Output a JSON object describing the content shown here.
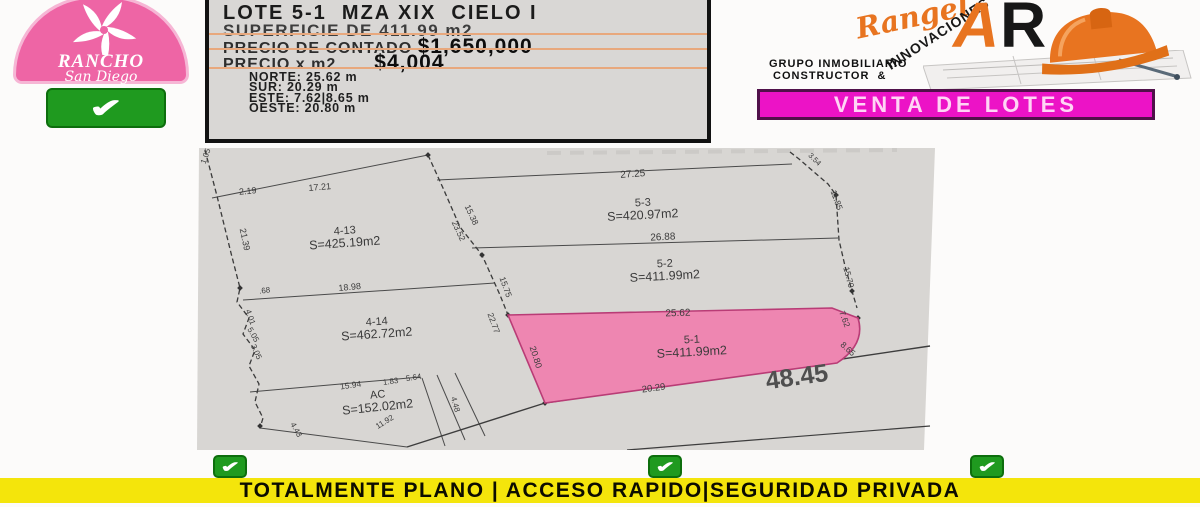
{
  "icons": {
    "check": "✔"
  },
  "colors": {
    "badge_pink": "#ee65a5",
    "check_green": "#1f9a1f",
    "magenta_banner": "#ec13c6",
    "orange_brand": "#e87420",
    "yellow_banner": "#f4e50b",
    "lot_highlight": "#ee86b1",
    "map_background": "#d8d6d3"
  },
  "header": {
    "badge": {
      "line1": "RANCHO",
      "line2": "San Diego"
    },
    "info": {
      "title": "LOTE 5-1  MZA XIX  CIELO I",
      "superficie_label": "SUPERFICIE DE ",
      "superficie_value": "411.99 m2",
      "contado_label": "PRECIO DE CONTADO ",
      "contado_value": "$1,650,000",
      "m2_label": "PRECIO x m2",
      "m2_value": "$4,004",
      "bounds": [
        {
          "label": "NORTE:",
          "value": " 25.62 m"
        },
        {
          "label": "SUR:",
          "value": " 20.29 m"
        },
        {
          "label": "ESTE:",
          "value": " 7.62|8.65 m"
        },
        {
          "label": "OESTE:",
          "value": " 20.80 m"
        }
      ]
    },
    "brand": {
      "script": "Rangel",
      "innovaciones": "INNOVACIONES",
      "monogram_a": "A",
      "monogram_r": "R",
      "tagline": "GRUPO INMOBILIARIO\n CONSTRUCTOR  &"
    },
    "venta_banner": "VENTA DE LOTES"
  },
  "map": {
    "street_label": "48.45",
    "lots": [
      {
        "id": "4-13",
        "area": "S=425.19m2",
        "x": 148,
        "y": 86,
        "r": -4
      },
      {
        "id": "5-3",
        "area": "S=420.97m2",
        "x": 446,
        "y": 58,
        "r": -3
      },
      {
        "id": "5-2",
        "area": "S=411.99m2",
        "x": 468,
        "y": 119,
        "r": -3
      },
      {
        "id": "4-14",
        "area": "S=462.72m2",
        "x": 180,
        "y": 177,
        "r": -4
      },
      {
        "id": "AC",
        "area": "S=152.02m2",
        "x": 181,
        "y": 250,
        "r": -6
      },
      {
        "id": "5-1",
        "area": "S=411.99m2",
        "x": 495,
        "y": 195,
        "r": -3,
        "highlighted": true
      }
    ],
    "labels": [
      {
        "t": "1.05",
        "x": 11,
        "y": 9,
        "r": -70,
        "s": 8
      },
      {
        "t": "2.19",
        "x": 51,
        "y": 46,
        "r": -5,
        "s": 9
      },
      {
        "t": "17.21",
        "x": 123,
        "y": 42,
        "r": -5,
        "s": 9
      },
      {
        "t": "21.39",
        "x": 45,
        "y": 92,
        "r": 78,
        "s": 9
      },
      {
        "t": ".68",
        "x": 68,
        "y": 145,
        "r": -8,
        "s": 8
      },
      {
        "t": "18.98",
        "x": 153,
        "y": 142,
        "r": -6,
        "s": 9
      },
      {
        "t": "15.38",
        "x": 272,
        "y": 68,
        "r": 65,
        "s": 8.5
      },
      {
        "t": "23.52",
        "x": 259,
        "y": 84,
        "r": 65,
        "s": 8.5
      },
      {
        "t": "27.25",
        "x": 436,
        "y": 29,
        "r": -4,
        "s": 10
      },
      {
        "t": "26.88",
        "x": 466,
        "y": 92,
        "r": -3,
        "s": 10
      },
      {
        "t": "3.54",
        "x": 616,
        "y": 13,
        "r": 45,
        "s": 7.5
      },
      {
        "t": "11.85",
        "x": 637,
        "y": 53,
        "r": 70,
        "s": 8.5
      },
      {
        "t": "15.70",
        "x": 649,
        "y": 130,
        "r": 75,
        "s": 8.5
      },
      {
        "t": "15.75",
        "x": 306,
        "y": 140,
        "r": 70,
        "s": 8.5
      },
      {
        "t": "22.77",
        "x": 294,
        "y": 176,
        "r": 70,
        "s": 8.5
      },
      {
        "t": "4.01",
        "x": 51,
        "y": 170,
        "r": 70,
        "s": 8
      },
      {
        "t": "5.05",
        "x": 54,
        "y": 188,
        "r": 60,
        "s": 8
      },
      {
        "t": "3.05",
        "x": 57,
        "y": 205,
        "r": 65,
        "s": 8
      },
      {
        "t": "15.94",
        "x": 154,
        "y": 240,
        "r": -8,
        "s": 8.5
      },
      {
        "t": "1.83",
        "x": 194,
        "y": 236,
        "r": -8,
        "s": 8
      },
      {
        "t": "5.64",
        "x": 217,
        "y": 232,
        "r": -8,
        "s": 8
      },
      {
        "t": "11.92",
        "x": 189,
        "y": 276,
        "r": -32,
        "s": 8
      },
      {
        "t": "4.43",
        "x": 97,
        "y": 283,
        "r": 60,
        "s": 8
      },
      {
        "t": "4.48",
        "x": 256,
        "y": 257,
        "r": 75,
        "s": 8
      },
      {
        "t": "20.80",
        "x": 336,
        "y": 210,
        "r": 72,
        "s": 9
      },
      {
        "t": "25.62",
        "x": 481,
        "y": 168,
        "r": -2,
        "s": 10
      },
      {
        "t": "20.29",
        "x": 457,
        "y": 243,
        "r": -8,
        "s": 9.5
      },
      {
        "t": "7.62",
        "x": 645,
        "y": 172,
        "r": 70,
        "s": 8.5
      },
      {
        "t": "8.65",
        "x": 649,
        "y": 203,
        "r": 42,
        "s": 8.5
      },
      {
        "t": "48.45",
        "x": 601,
        "y": 237,
        "r": -8,
        "s": 25,
        "c": "#4f4f4f",
        "b": true
      }
    ]
  },
  "footer": {
    "banner": "TOTALMENTE PLANO | ACCESO RAPIDO|SEGURIDAD PRIVADA"
  }
}
